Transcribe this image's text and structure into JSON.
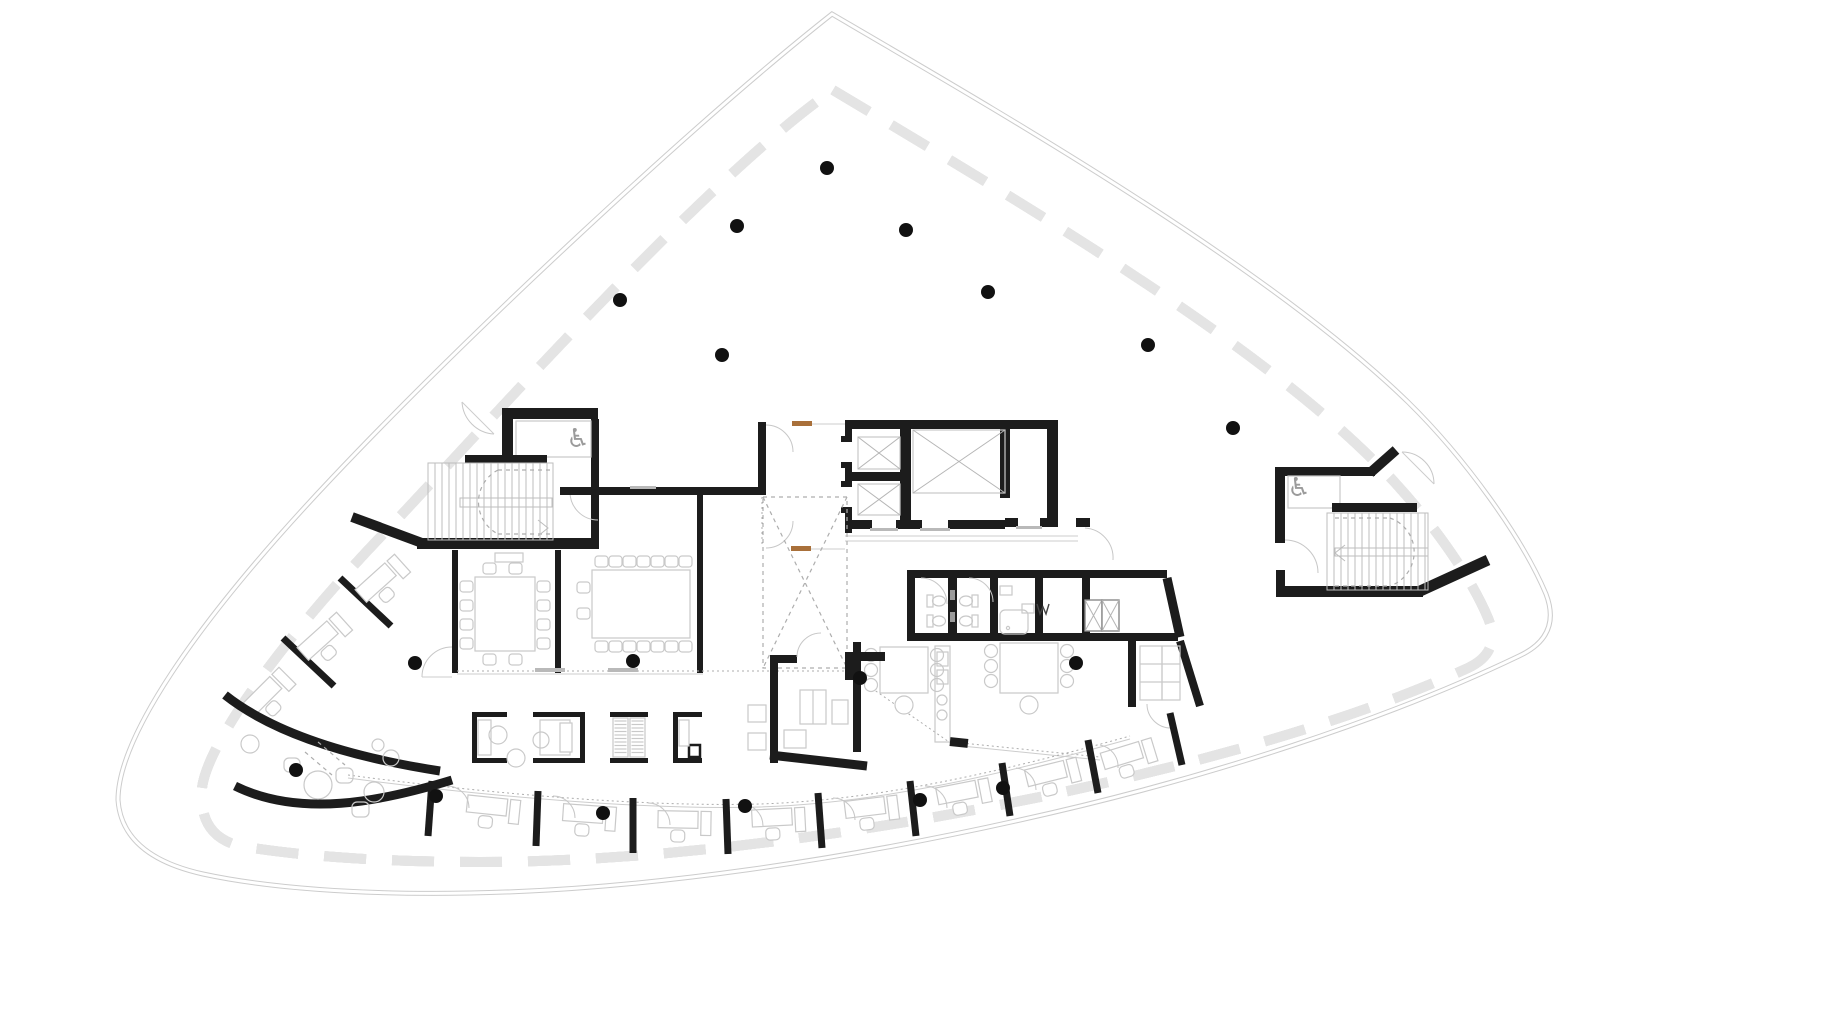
{
  "document": {
    "kind": "architectural-floor-plan",
    "building_shape": "curved-triangular-tower-floor",
    "visible_text": []
  },
  "canvas": {
    "width": 1830,
    "height": 1028,
    "background": "#ffffff"
  },
  "colors": {
    "wall": "#1c1c1c",
    "furniture": "#c9c9c9",
    "stair": "#bdbdbd",
    "dash": "#adadad",
    "facade_line": "#9a9a9a",
    "facade_band": "#e4e4e4",
    "outer_line": "#cccccc",
    "column": "#111111",
    "door_accent": "#a9703a",
    "icon": "#9b9b9b"
  },
  "columns": [
    [
      620,
      300
    ],
    [
      737,
      226
    ],
    [
      827,
      168
    ],
    [
      906,
      230
    ],
    [
      988,
      292
    ],
    [
      722,
      355
    ],
    [
      1148,
      345
    ],
    [
      1233,
      428
    ],
    [
      415,
      663
    ],
    [
      633,
      661
    ],
    [
      860,
      678
    ],
    [
      1076,
      663
    ],
    [
      296,
      770
    ],
    [
      436,
      796
    ],
    [
      603,
      813
    ],
    [
      745,
      806
    ],
    [
      920,
      800
    ],
    [
      1003,
      788
    ]
  ],
  "accent_doors": [
    {
      "x": 792,
      "y": 421,
      "w": 20,
      "h": 5
    },
    {
      "x": 791,
      "y": 546,
      "w": 20,
      "h": 5
    }
  ],
  "stairs": [
    {
      "id": "west",
      "x0": 428,
      "x1": 553,
      "y0": 463,
      "y1": 540,
      "step": 7,
      "rail": [
        460,
        498,
        92,
        9
      ],
      "header": [
        465,
        455,
        82,
        8
      ],
      "arc_cx": 462,
      "arc_cy": 501,
      "arc_r": 36
    },
    {
      "id": "east",
      "x0": 1327,
      "x1": 1428,
      "y0": 513,
      "y1": 590,
      "step": 7,
      "rail": [
        1335,
        548,
        93,
        8
      ],
      "header": [
        1332,
        503,
        85,
        9
      ],
      "arc_cx": 1424,
      "arc_cy": 551,
      "arc_r": 36
    }
  ],
  "party_walls_bottom": [
    [
      432,
      781,
      428,
      836
    ],
    [
      538,
      791,
      536,
      846
    ],
    [
      633,
      798,
      633,
      853
    ],
    [
      726,
      799,
      728,
      854
    ],
    [
      818,
      793,
      822,
      848
    ],
    [
      910,
      781,
      916,
      836
    ],
    [
      1002,
      763,
      1010,
      816
    ],
    [
      1088,
      740,
      1098,
      793
    ],
    [
      1170,
      713,
      1182,
      765
    ]
  ],
  "party_walls_west": [
    [
      340,
      578,
      391,
      626
    ],
    [
      283,
      638,
      334,
      686
    ]
  ],
  "desks_bottom": [
    [
      487,
      806,
      6
    ],
    [
      583,
      814,
      4
    ],
    [
      678,
      820,
      1
    ],
    [
      772,
      818,
      -3
    ],
    [
      865,
      808,
      -7
    ],
    [
      957,
      793,
      -11
    ],
    [
      1046,
      774,
      -14
    ],
    [
      1122,
      756,
      -17
    ]
  ],
  "desks_west": [
    [
      376,
      583,
      -42
    ],
    [
      318,
      641,
      -42
    ],
    [
      262,
      697,
      -45
    ]
  ],
  "booths": [
    {
      "x": 472,
      "y": 712,
      "w": 35,
      "h": 51,
      "side": "left",
      "fill": "daybed"
    },
    {
      "x": 533,
      "y": 712,
      "w": 52,
      "h": 51,
      "side": "right",
      "fill": "bed"
    },
    {
      "x": 610,
      "y": 712,
      "w": 38,
      "h": 51,
      "side": "none",
      "fill": "wardrobes"
    },
    {
      "x": 673,
      "y": 712,
      "w": 29,
      "h": 51,
      "side": "left",
      "fill": "unit"
    }
  ],
  "wheelchair_wcs": [
    {
      "x": 578,
      "y": 447
    },
    {
      "x": 1299,
      "y": 496
    }
  ],
  "break_tables": [
    {
      "x": 880,
      "y": 647,
      "w": 48,
      "h": 46
    },
    {
      "x": 1000,
      "y": 643,
      "w": 58,
      "h": 50
    }
  ],
  "meeting_tables": [
    {
      "x": 475,
      "y": 577,
      "w": 60,
      "h": 74,
      "seats": 12
    },
    {
      "x": 592,
      "y": 570,
      "w": 98,
      "h": 68,
      "seats": 16
    }
  ]
}
